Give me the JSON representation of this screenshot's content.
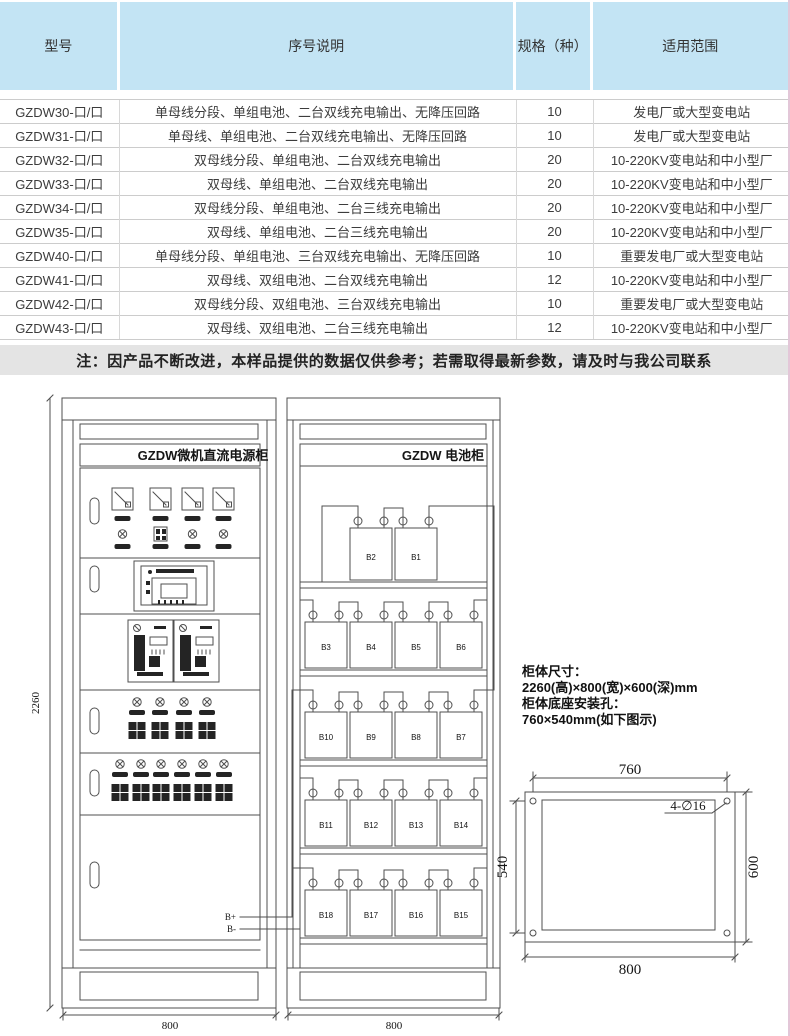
{
  "table": {
    "headers": [
      "型号",
      "序号说明",
      "规格（种）",
      "适用范围"
    ],
    "rows": [
      {
        "model": "GZDW30-口/口",
        "description": "单母线分段、单组电池、二台双线充电输出、无降压回路",
        "spec": "10",
        "range": "发电厂或大型变电站"
      },
      {
        "model": "GZDW31-口/口",
        "description": "单母线、单组电池、二台双线充电输出、无降压回路",
        "spec": "10",
        "range": "发电厂或大型变电站"
      },
      {
        "model": "GZDW32-口/口",
        "description": "双母线分段、单组电池、二台双线充电输出",
        "spec": "20",
        "range": "10-220KV变电站和中小型厂"
      },
      {
        "model": "GZDW33-口/口",
        "description": "双母线、单组电池、二台双线充电输出",
        "spec": "20",
        "range": "10-220KV变电站和中小型厂"
      },
      {
        "model": "GZDW34-口/口",
        "description": "双母线分段、单组电池、二台三线充电输出",
        "spec": "20",
        "range": "10-220KV变电站和中小型厂"
      },
      {
        "model": "GZDW35-口/口",
        "description": "双母线、单组电池、二台三线充电输出",
        "spec": "20",
        "range": "10-220KV变电站和中小型厂"
      },
      {
        "model": "GZDW40-口/口",
        "description": "单母线分段、单组电池、三台双线充电输出、无降压回路",
        "spec": "10",
        "range": "重要发电厂或大型变电站"
      },
      {
        "model": "GZDW41-口/口",
        "description": "双母线、双组电池、二台双线充电输出",
        "spec": "12",
        "range": "10-220KV变电站和中小型厂"
      },
      {
        "model": "GZDW42-口/口",
        "description": "双母线分段、双组电池、三台双线充电输出",
        "spec": "10",
        "range": "重要发电厂或大型变电站"
      },
      {
        "model": "GZDW43-口/口",
        "description": "双母线、双组电池、二台三线充电输出",
        "spec": "12",
        "range": "10-220KV变电站和中小型厂"
      }
    ]
  },
  "note": "注：因产品不断改进，本样品提供的数据仅供参考；若需取得最新参数，请及时与我公司联系",
  "drawing": {
    "left_cabinet": {
      "title": "GZDW微机直流电源柜",
      "height_dim": "2260",
      "width_dim": "800",
      "bplus": "B+",
      "bminus": "B-"
    },
    "right_cabinet": {
      "title": "GZDW 电池柜",
      "width_dim": "800",
      "rows": [
        {
          "labels": [
            "B2",
            "B1"
          ]
        },
        {
          "labels": [
            "B3",
            "B4",
            "B5",
            "B6"
          ]
        },
        {
          "labels": [
            "B10",
            "B9",
            "B8",
            "B7"
          ]
        },
        {
          "labels": [
            "B11",
            "B12",
            "B13",
            "B14"
          ]
        },
        {
          "labels": [
            "B18",
            "B17",
            "B16",
            "B15"
          ]
        }
      ]
    },
    "specs": {
      "line1": "柜体尺寸：",
      "line2": "2260(高)×800(宽)×600(深)mm",
      "line3": "柜体底座安装孔：",
      "line4": "760×540mm(如下图示)"
    },
    "base_diagram": {
      "top_dim": "760",
      "bottom_dim": "800",
      "left_dim": "540",
      "right_dim": "600",
      "holes_note": "4-∅16"
    }
  },
  "colors": {
    "header_bg": "#c3e4f4",
    "note_bg": "#e4e4e4",
    "line": "#4f4f4f",
    "page_edge": "#e3c7d8"
  }
}
